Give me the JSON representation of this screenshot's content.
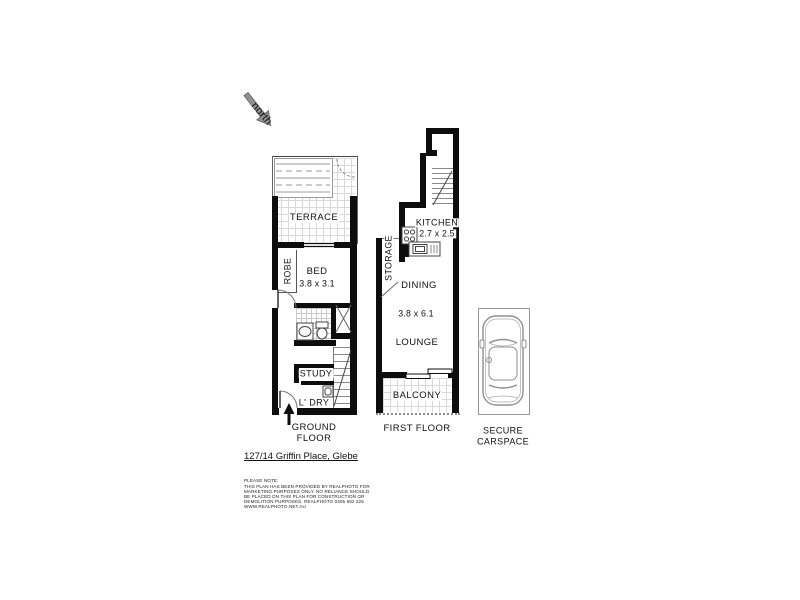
{
  "north": {
    "label": "north"
  },
  "ground_floor": {
    "caption_line1": "GROUND",
    "caption_line2": "FLOOR",
    "terrace": "TERRACE",
    "robe": "ROBE",
    "bed": "BED",
    "bed_dims": "3.8 x 3.1",
    "study": "STUDY",
    "laundry": "L' DRY"
  },
  "first_floor": {
    "caption": "FIRST FLOOR",
    "kitchen": "KITCHEN",
    "kitchen_dims": "2.7 x 2.5",
    "storage": "STORAGE",
    "dining": "DINING",
    "living_dims": "3.8 x 6.1",
    "lounge": "LOUNGE",
    "balcony": "BALCONY"
  },
  "carspace": {
    "caption_line1": "SECURE",
    "caption_line2": "CARSPACE"
  },
  "footer": {
    "address": "127/14 Griffin Place, Glebe",
    "disclaimer": [
      "PLEASE NOTE:",
      "THIS PLAN HAS BEEN PROVIDED BY REALPHOTO FOR",
      "MARKETING PURPOSES ONLY. NO RELIANCE SHOULD",
      "BE PLACED ON THIS PLAN FOR CONSTRUCTION OR",
      "DEMOLITION PURPOSES. REALPHOTO 0405 682 225",
      "WWW.REALPHOTO.NET.AU"
    ]
  },
  "colors": {
    "wall": "#0d0d0d",
    "thin_line": "#555555",
    "tile_line": "#d9d9d9",
    "car_outline": "#8f8f8f"
  }
}
